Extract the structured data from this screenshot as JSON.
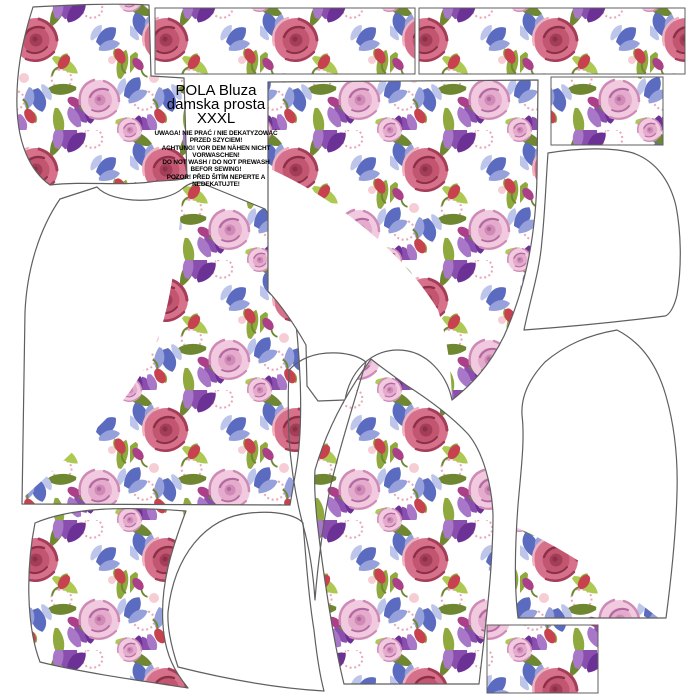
{
  "sheet": {
    "title_line1": "POLA Bluza",
    "title_line2": "damska prosta",
    "title_line3": "XXXL",
    "warnings": [
      "UWAGA! NIE PRAĆ / NIE DEKATYZOWAĆ",
      "PRZED SZYCIEM!",
      "ACHTUNG! VOR DEM NÄHEN NICHT",
      "VORWASCHEN!",
      "DO NOT WASH / DO NOT PREWASH",
      "BEFOR SEWING!",
      "POZOR! PŘED ŠITÍM NEPERTE A",
      "NEDEKATUJTE!"
    ]
  },
  "pieces": [
    {
      "name": "sleeve-cap-panel-top-left",
      "fill": "floral"
    },
    {
      "name": "border-strip-left",
      "fill": "floral"
    },
    {
      "name": "border-strip-right",
      "fill": "floral"
    },
    {
      "name": "fabric-swatch-top-right",
      "fill": "floral"
    },
    {
      "name": "front-bodice-panel",
      "fill": "floral-partial"
    },
    {
      "name": "back-panel",
      "fill": "floral-partial"
    },
    {
      "name": "sleeve-panel-center",
      "fill": "floral"
    },
    {
      "name": "sleeve-cap-outline",
      "fill": "white"
    },
    {
      "name": "sleeve-outline-bottom-center",
      "fill": "white"
    },
    {
      "name": "side-panel-bottom-left",
      "fill": "floral"
    },
    {
      "name": "hood-outline-right",
      "fill": "white"
    },
    {
      "name": "panel-outline-bottom-right",
      "fill": "floral-partial"
    },
    {
      "name": "fabric-swatch-bottom-right",
      "fill": "floral"
    }
  ],
  "colors": {
    "bg": "#ffffff",
    "outline": "#5f5f5f",
    "textColor": "#000000",
    "rose1": "#d7718b",
    "rose2": "#c25670",
    "rose3": "#a43e58",
    "rose4": "#8c3048",
    "roseHi": "#f1b3c0",
    "pink1": "#f2cadf",
    "pink2": "#e4abcd",
    "pink3": "#cf8ab6",
    "pink4": "#b268a0",
    "purple1": "#8a4fae",
    "purple2": "#6b3195",
    "purple3": "#a977c8",
    "blue1": "#5b6cc0",
    "blue2": "#96a1dc",
    "blue3": "#bdc5eb",
    "green1": "#8fa93e",
    "green2": "#6f8731",
    "green3": "#aec952",
    "redBud": "#c7414f",
    "magentaBud": "#ab3f88",
    "swirl": "#e9a6b6",
    "palePink": "#f6cdd4"
  }
}
